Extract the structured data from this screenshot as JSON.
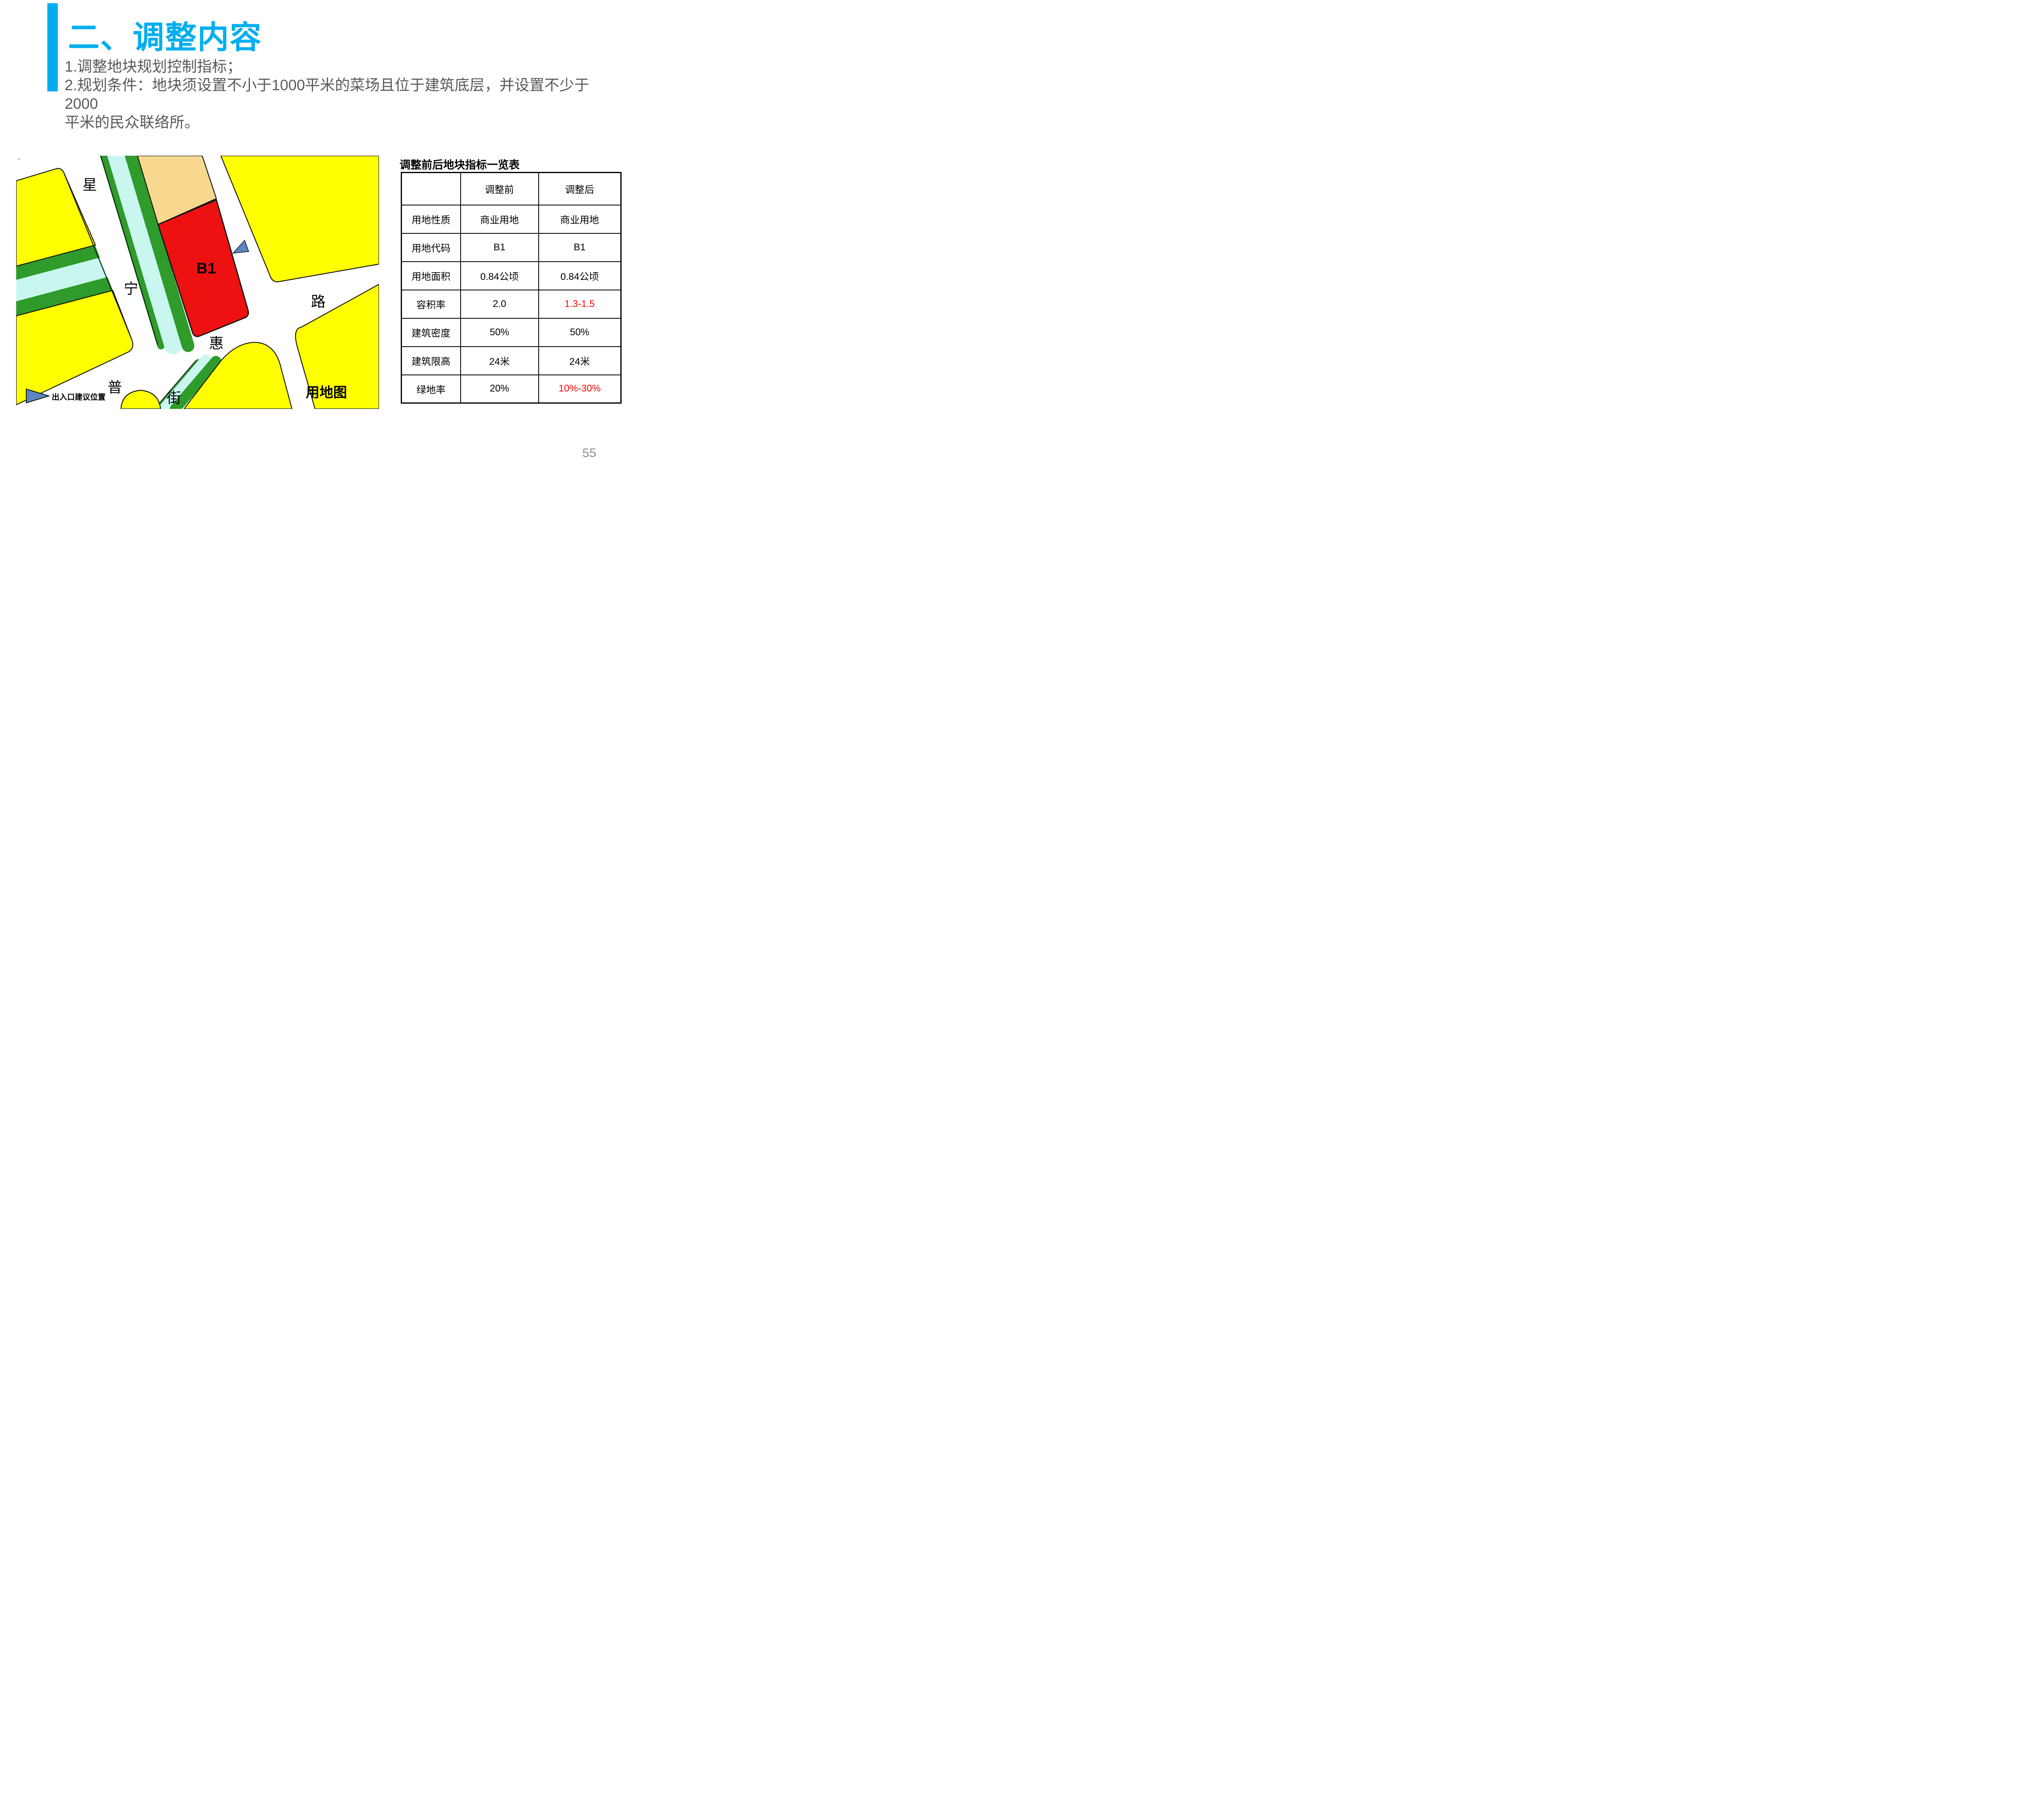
{
  "slide": {
    "title": "二、调整内容",
    "body_lines": [
      "1.调整地块规划控制指标；",
      "2.规划条件：地块须设置不小于1000平米的菜场且位于建筑底层，并设置不少于2000",
      "平米的民众联络所。"
    ],
    "page_number": "55"
  },
  "map": {
    "plot_label": "B1",
    "street_chars": {
      "xing": "星",
      "ning": "宁",
      "lu": "路",
      "hui": "惠",
      "pu": "普",
      "jie": "街"
    },
    "legend_text": "出入口建议位置",
    "caption": "用地图",
    "corner_mark": "~"
  },
  "table": {
    "title": "调整前后地块指标一览表",
    "columns": [
      "",
      "调整前",
      "调整后"
    ],
    "rows": [
      {
        "label": "用地性质",
        "before": "商业用地",
        "after": "商业用地",
        "highlight": false
      },
      {
        "label": "用地代码",
        "before": "B1",
        "after": "B1",
        "highlight": false
      },
      {
        "label": "用地面积",
        "before": "0.84公顷",
        "after": "0.84公顷",
        "highlight": false
      },
      {
        "label": "容积率",
        "before": "2.0",
        "after": "1.3-1.5",
        "highlight": true
      },
      {
        "label": "建筑密度",
        "before": "50%",
        "after": "50%",
        "highlight": false
      },
      {
        "label": "建筑限高",
        "before": "24米",
        "after": "24米",
        "highlight": false
      },
      {
        "label": "绿地率",
        "before": "20%",
        "after": "10%-30%",
        "highlight": true
      }
    ]
  },
  "colors": {
    "accent_blue": "#00AEEF",
    "body_text": "#595959",
    "map_yellow": "#FFFF00",
    "map_green": "#2E9B2B",
    "map_cyan": "#C9F7F0",
    "map_tan": "#F7D88E",
    "map_red": "#EE1111",
    "marker_blue": "#5B87BE",
    "table_highlight_red": "#FF0000",
    "page_number_gray": "#8F8F8F"
  }
}
